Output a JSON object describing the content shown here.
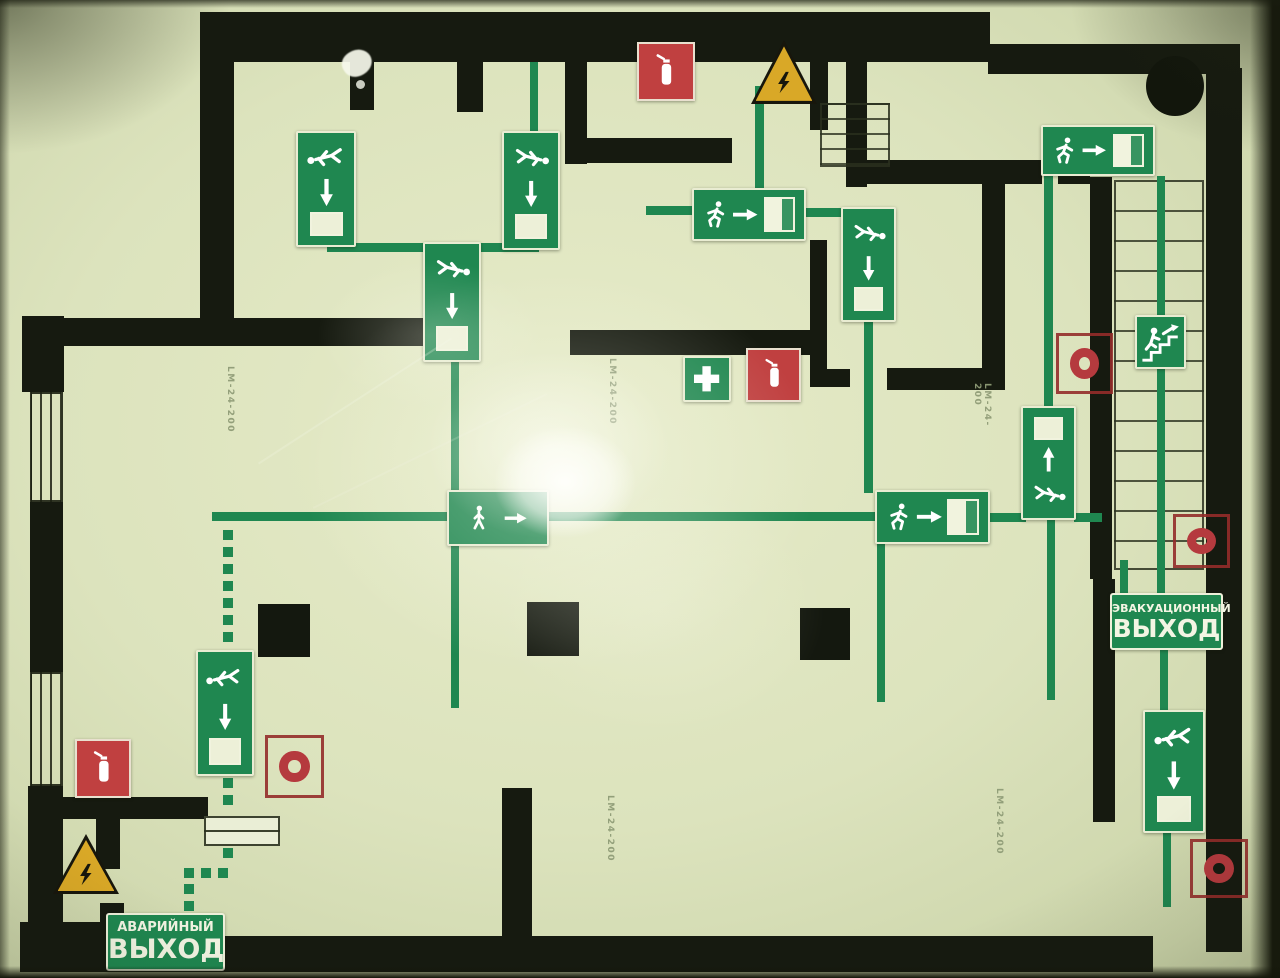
{
  "title": "Photographed evacuation floor plan (glow-in-the-dark placard)",
  "exit_labels": {
    "evacuation": {
      "line1": "ЭВАКУАЦИОННЫЙ",
      "line2": "ВЫХОД"
    },
    "emergency": {
      "line1": "АВАРИЙНЫЙ",
      "line2": "ВЫХОД"
    }
  },
  "equipment_labels": {
    "luminaire_model": "LM-24-200"
  },
  "colors": {
    "background_cream": "#dce3bd",
    "wall_black": "#161a10",
    "route_green": "#1f8750",
    "sign_green": "#1f8750",
    "extinguisher_red": "#c04040",
    "alarm_ring_red": "#b53a3e",
    "hazard_yellow": "#d9a827",
    "label_ink": "#8f9c77"
  },
  "floorplan": {
    "walls": [
      [
        200,
        12,
        790,
        50
      ],
      [
        988,
        44,
        252,
        30
      ],
      [
        1206,
        68,
        36,
        884
      ],
      [
        45,
        936,
        1108,
        36
      ],
      [
        22,
        316,
        42,
        76
      ],
      [
        30,
        502,
        33,
        170
      ],
      [
        28,
        786,
        35,
        140
      ],
      [
        20,
        922,
        82,
        50
      ],
      [
        33,
        318,
        412,
        28
      ],
      [
        200,
        12,
        34,
        318
      ],
      [
        350,
        62,
        24,
        48
      ],
      [
        457,
        62,
        26,
        50
      ],
      [
        565,
        12,
        22,
        152
      ],
      [
        565,
        138,
        167,
        25
      ],
      [
        810,
        56,
        18,
        74
      ],
      [
        846,
        42,
        21,
        145
      ],
      [
        867,
        160,
        175,
        24
      ],
      [
        1058,
        160,
        32,
        24
      ],
      [
        982,
        184,
        23,
        206
      ],
      [
        887,
        368,
        118,
        22
      ],
      [
        810,
        240,
        17,
        147
      ],
      [
        810,
        369,
        40,
        18
      ],
      [
        1090,
        177,
        22,
        402
      ],
      [
        570,
        330,
        257,
        25
      ],
      [
        28,
        797,
        180,
        22
      ],
      [
        96,
        819,
        24,
        50
      ],
      [
        502,
        788,
        30,
        150
      ],
      [
        1093,
        579,
        22,
        243
      ],
      [
        100,
        903,
        24,
        34
      ]
    ],
    "pillars": [
      [
        258,
        604,
        52,
        53
      ],
      [
        527,
        602,
        52,
        54
      ],
      [
        800,
        608,
        50,
        52
      ]
    ],
    "windows": [
      [
        30,
        392,
        33,
        110
      ],
      [
        30,
        672,
        33,
        114
      ]
    ],
    "route_lines": [
      [
        451,
        358,
        8,
        350
      ],
      [
        212,
        512,
        240,
        9
      ],
      [
        548,
        512,
        330,
        9
      ],
      [
        988,
        513,
        38,
        9
      ],
      [
        1074,
        513,
        28,
        9
      ],
      [
        327,
        243,
        212,
        9
      ],
      [
        755,
        86,
        9,
        122
      ],
      [
        646,
        206,
        50,
        9
      ],
      [
        804,
        208,
        39,
        9
      ],
      [
        864,
        318,
        9,
        175
      ],
      [
        877,
        542,
        8,
        160
      ],
      [
        1044,
        174,
        9,
        234
      ],
      [
        1047,
        518,
        8,
        182
      ],
      [
        1157,
        176,
        8,
        418
      ],
      [
        1120,
        560,
        8,
        34
      ],
      [
        1160,
        650,
        8,
        62
      ],
      [
        1163,
        831,
        8,
        76
      ],
      [
        530,
        62,
        8,
        70
      ]
    ],
    "door_swings": [
      [
        316,
        62,
        78,
        60
      ],
      [
        440,
        62,
        88,
        60
      ],
      [
        596,
        60,
        60,
        56
      ]
    ],
    "dashed_segments": [
      {
        "x": 223,
        "y": 530,
        "length": 118,
        "dir": "v"
      },
      {
        "x": 223,
        "y": 778,
        "length": 36,
        "dir": "v"
      },
      {
        "x": 223,
        "y": 848,
        "length": 22,
        "dir": "v"
      },
      {
        "x": 184,
        "y": 868,
        "length": 52,
        "dir": "h"
      },
      {
        "x": 184,
        "y": 884,
        "length": 30,
        "dir": "v"
      }
    ],
    "stairs": {
      "main": {
        "x": 1114,
        "y": 180,
        "w": 90,
        "h": 390
      },
      "mini": {
        "x": 820,
        "y": 103,
        "w": 70,
        "h": 64
      }
    },
    "furniture": [
      {
        "name": "table",
        "x": 204,
        "y": 816,
        "w": 76,
        "h": 30
      }
    ],
    "column_circle": {
      "x": 1146,
      "y": 56,
      "w": 58,
      "h": 60
    },
    "signs": [
      {
        "icon": "crawl-man-down",
        "kind": "route-v",
        "x": 296,
        "y": 131,
        "w": 60,
        "h": 116,
        "flip": false
      },
      {
        "icon": "crawl-man-down",
        "kind": "route-v",
        "x": 502,
        "y": 131,
        "w": 58,
        "h": 119,
        "flip": true
      },
      {
        "icon": "crawl-man-down",
        "kind": "route-v",
        "x": 423,
        "y": 242,
        "w": 58,
        "h": 120,
        "flip": true
      },
      {
        "icon": "exit-man-right",
        "kind": "route-h",
        "x": 692,
        "y": 188,
        "w": 114,
        "h": 53
      },
      {
        "icon": "crawl-man-down",
        "kind": "route-v",
        "x": 841,
        "y": 207,
        "w": 55,
        "h": 115,
        "flip": true
      },
      {
        "icon": "first-aid",
        "kind": "firstaid",
        "x": 683,
        "y": 356,
        "w": 48,
        "h": 46
      },
      {
        "icon": "fire-extinguisher",
        "kind": "extinguisher",
        "x": 746,
        "y": 348,
        "w": 55,
        "h": 54
      },
      {
        "icon": "fire-extinguisher",
        "kind": "extinguisher",
        "x": 637,
        "y": 42,
        "w": 58,
        "h": 59
      },
      {
        "icon": "electric-hazard",
        "kind": "hazard",
        "x": 751,
        "y": 40,
        "w": 66,
        "h": 64
      },
      {
        "icon": "exit-man-right",
        "kind": "route-h",
        "x": 1041,
        "y": 125,
        "w": 114,
        "h": 51
      },
      {
        "icon": "stairs-up-man",
        "kind": "stairsman",
        "x": 1135,
        "y": 315,
        "w": 51,
        "h": 54
      },
      {
        "icon": "fire-alarm-ring",
        "kind": "ring",
        "x": 1056,
        "y": 333,
        "w": 57,
        "h": 61
      },
      {
        "icon": "crawl-man-up",
        "kind": "route-v-up",
        "x": 1021,
        "y": 406,
        "w": 55,
        "h": 114,
        "flip": true
      },
      {
        "icon": "fire-alarm-ring",
        "kind": "ring",
        "x": 1173,
        "y": 514,
        "w": 57,
        "h": 54
      },
      {
        "icon": "walking-man-right",
        "kind": "route-h-plain",
        "x": 447,
        "y": 490,
        "w": 102,
        "h": 56
      },
      {
        "icon": "exit-man-right",
        "kind": "route-h",
        "x": 875,
        "y": 490,
        "w": 115,
        "h": 54
      },
      {
        "icon": "crawl-man-down",
        "kind": "route-v",
        "x": 196,
        "y": 650,
        "w": 58,
        "h": 126,
        "flip": false
      },
      {
        "icon": "fire-extinguisher",
        "kind": "extinguisher",
        "x": 75,
        "y": 739,
        "w": 56,
        "h": 59
      },
      {
        "icon": "fire-alarm-ring",
        "kind": "ring",
        "x": 265,
        "y": 735,
        "w": 59,
        "h": 63
      },
      {
        "icon": "electric-hazard",
        "kind": "hazard",
        "x": 53,
        "y": 834,
        "w": 66,
        "h": 60
      },
      {
        "icon": "crawl-man-down",
        "kind": "route-v",
        "x": 1143,
        "y": 710,
        "w": 62,
        "h": 123,
        "flip": false
      },
      {
        "icon": "fire-alarm-ring",
        "kind": "ring",
        "x": 1190,
        "y": 839,
        "w": 58,
        "h": 59
      }
    ],
    "exit_sign_boxes": [
      {
        "key": "evacuation",
        "x": 1110,
        "y": 593,
        "w": 113,
        "h": 57,
        "f1": 11,
        "f2": 25
      },
      {
        "key": "emergency",
        "x": 106,
        "y": 913,
        "w": 119,
        "h": 58,
        "f1": 13,
        "f2": 27
      }
    ],
    "model_labels": [
      {
        "x": 221,
        "y": 366,
        "h": 80
      },
      {
        "x": 603,
        "y": 358,
        "h": 100
      },
      {
        "x": 978,
        "y": 383,
        "h": 50
      },
      {
        "x": 601,
        "y": 795,
        "h": 88
      },
      {
        "x": 990,
        "y": 788,
        "h": 88
      }
    ]
  }
}
